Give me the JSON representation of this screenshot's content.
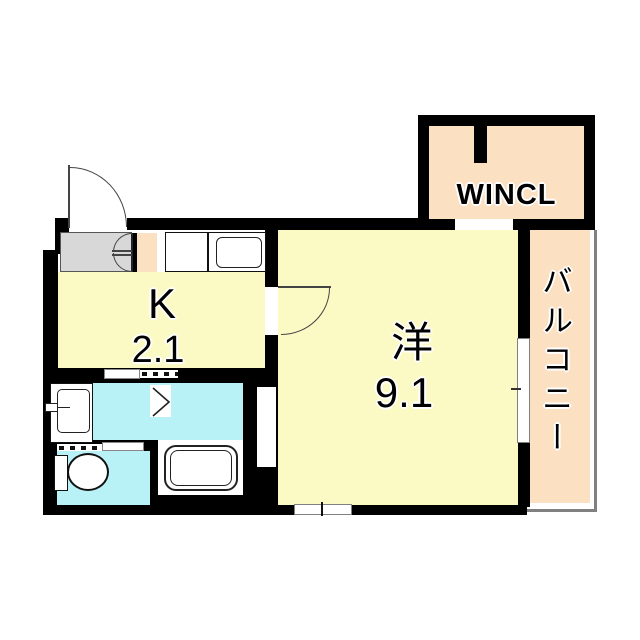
{
  "title": "apartment-floorplan",
  "rooms": {
    "kitchen": {
      "label": "K",
      "area": "2.1"
    },
    "western_room": {
      "label": "洋",
      "area": "9.1"
    },
    "walk_in_closet": {
      "label": "WINCL"
    },
    "balcony": {
      "label": "バルコニー"
    }
  },
  "colors": {
    "wall": "#000000",
    "yellow": "#FCFAC4",
    "peach": "#FBE0C2",
    "cyan": "#B8F1F6",
    "gray": "#D8D8D8",
    "window": "#808080"
  },
  "icons": [
    "entrance-door-icon",
    "closet-double-door-icon",
    "kitchen-sink-icon",
    "room-door-icon",
    "sliding-door-icon",
    "folding-door-icon",
    "washbasin-icon",
    "bathtub-icon",
    "toilet-icon",
    "window-icon",
    "door-opening-chevron-icon"
  ]
}
